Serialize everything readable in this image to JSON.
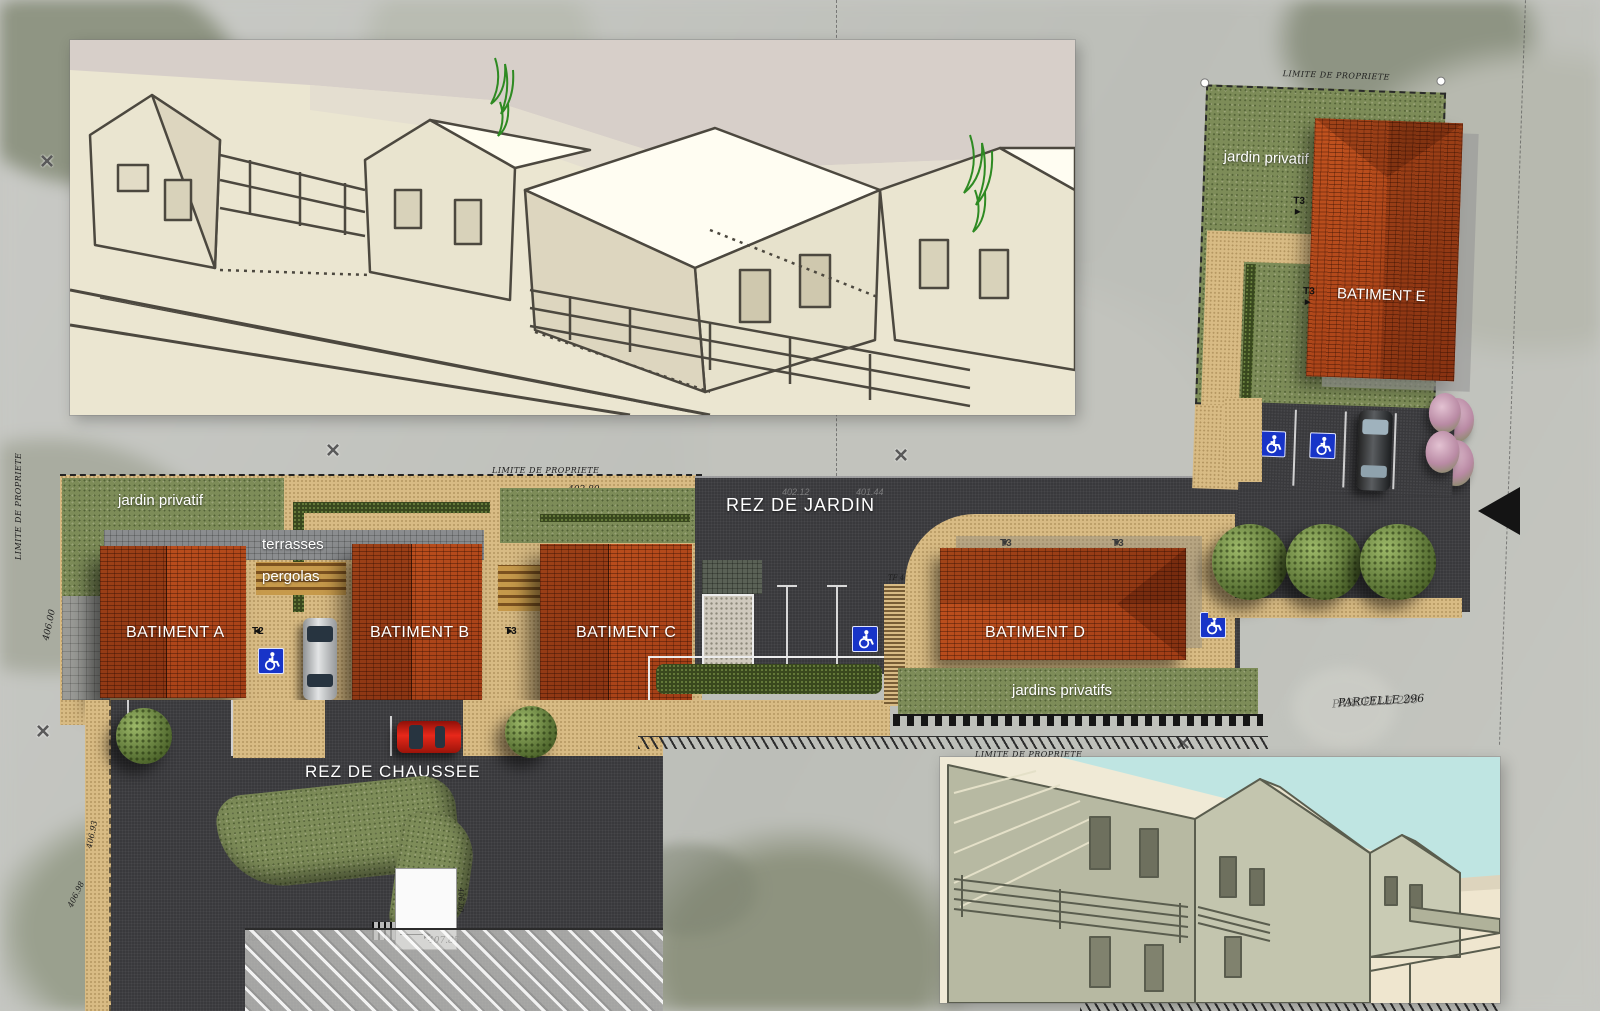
{
  "plan": {
    "boundary_label": "LIMITE DE PROPRIETE",
    "parcel_label": "PARCELLE 296",
    "levels": {
      "garden": "REZ DE JARDIN",
      "ground": "REZ DE CHAUSSEE"
    },
    "zones": {
      "private_garden": "jardin privatif",
      "private_gardens": "jardins privatifs",
      "terraces": "terrasses",
      "pergolas": "pergolas"
    },
    "buildings": {
      "a": "BATIMENT A",
      "b": "BATIMENT B",
      "c": "BATIMENT C",
      "d": "BATIMENT D",
      "e": "BATIMENT E"
    },
    "units": {
      "t2": "T2",
      "t3": "T3"
    },
    "dimensions": {
      "d402_80": "402.80",
      "d402_12": "402.12",
      "d401_44": "401.44",
      "d406_95": "406.95",
      "d407_85": "407.85",
      "d406_93": "406.93",
      "d406_98": "406.98",
      "d406_00": "406.00",
      "tf_403": "TF 403.53 env"
    },
    "icons": {
      "arrow_down": "▼",
      "arrow_right": "►",
      "arrow_left": "◄",
      "survey_cross": "×",
      "handicap": "wheelchair-symbol"
    },
    "colors": {
      "roof_red": "#b2451e",
      "asphalt": "#39393c",
      "sand": "#d8bb84",
      "grass": "#7d8c58",
      "terrace_gray": "#8b8d8f",
      "handicap_blue": "#1834c8",
      "boundary_ink": "#1d1d1d"
    }
  }
}
